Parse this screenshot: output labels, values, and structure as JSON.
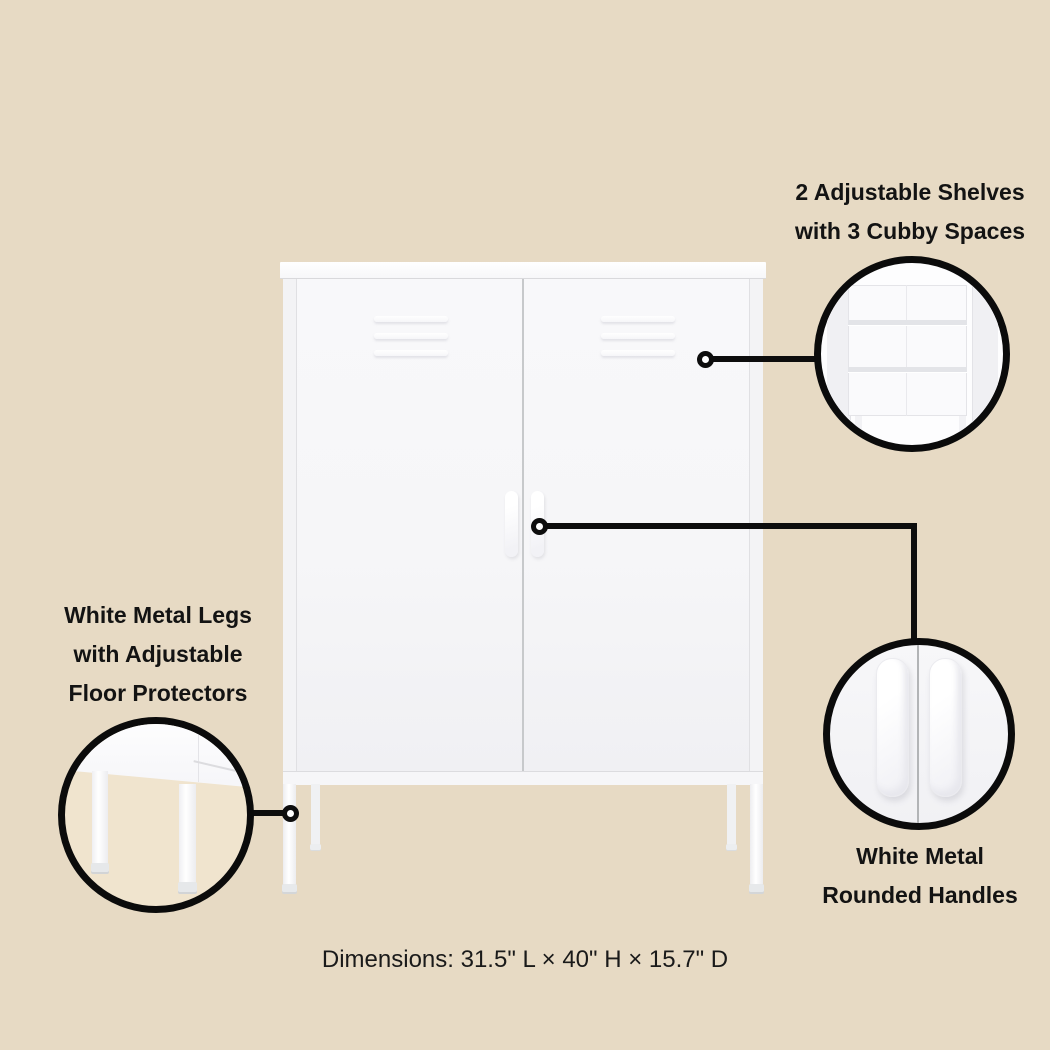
{
  "infographic": {
    "callout_shelves": {
      "lines": [
        "2 Adjustable Shelves",
        "with 3 Cubby Spaces"
      ]
    },
    "callout_legs": {
      "lines": [
        "White Metal Legs",
        "with Adjustable",
        "Floor Protectors"
      ]
    },
    "callout_handles": {
      "lines": [
        "White Metal",
        "Rounded Handles"
      ]
    },
    "dimensions_text": "Dimensions: 31.5\" L × 40\" H × 15.7\" D",
    "colors": {
      "background": "#e7dac4",
      "callout_line": "#0d0d0d",
      "cabinet_white": "#f6f6f8",
      "label_text": "#131313"
    }
  }
}
